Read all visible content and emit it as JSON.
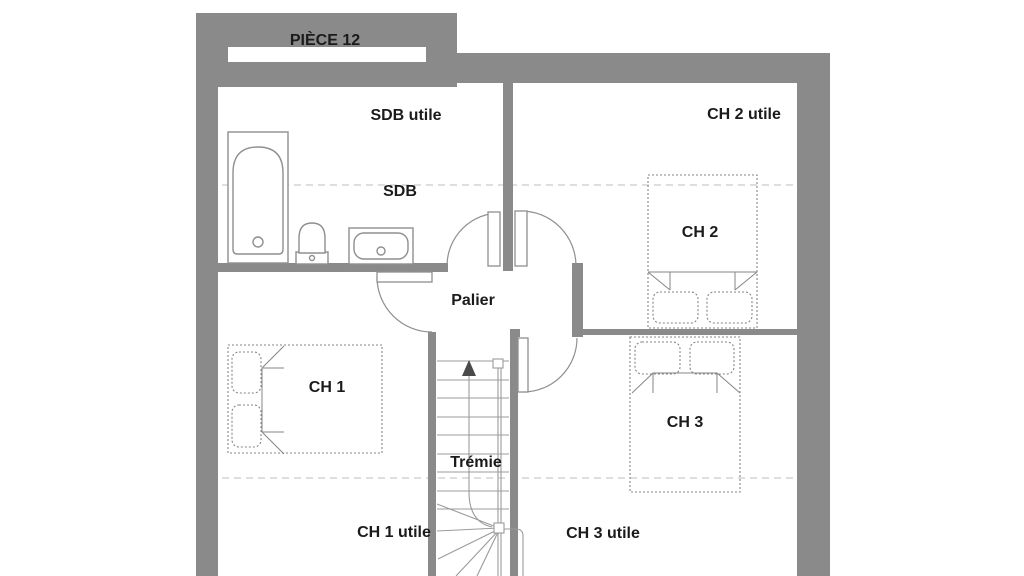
{
  "plan": {
    "title": "PIÈCE 12",
    "rooms": {
      "sdb": {
        "label": "SDB",
        "zone_label": "SDB utile"
      },
      "ch1": {
        "label": "CH 1",
        "zone_label": "CH 1 utile"
      },
      "ch2": {
        "label": "CH 2",
        "zone_label": "CH 2 utile"
      },
      "ch3": {
        "label": "CH 3",
        "zone_label": "CH 3 utile"
      },
      "palier": {
        "label": "Palier"
      },
      "tremie": {
        "label": "Trémie"
      }
    }
  },
  "colors": {
    "background": "#ffffff",
    "wall": "#8a8a8a",
    "fixture_line": "#8f8f8f",
    "bed_line": "#858585",
    "stair_line": "#9b9b9b",
    "dashed_line": "#c9c9c9",
    "arrow": "#4a4a4a",
    "text": "#1b1b1b"
  }
}
